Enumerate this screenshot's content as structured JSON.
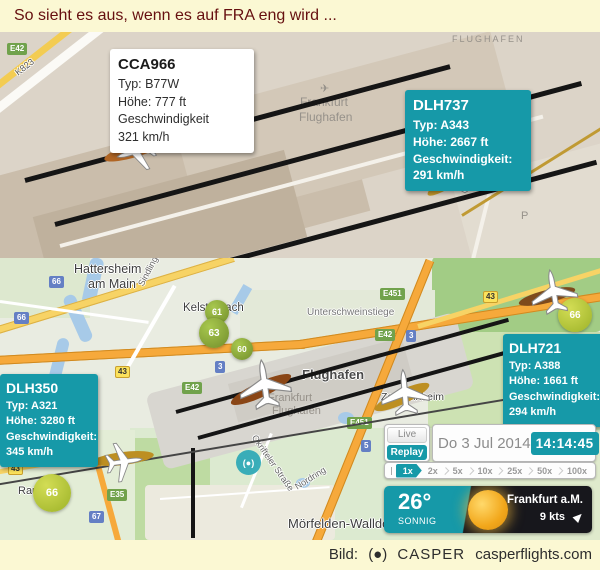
{
  "header": {
    "title": "So sieht es aus, wenn es auf FRA eng wird ..."
  },
  "footer": {
    "label": "Bild:",
    "logo": "(●)",
    "brand": "CASPER",
    "site": "casperflights.com"
  },
  "colors": {
    "accent_teal": "#1699a8",
    "runway": "#151515",
    "noise_green": "#8fb73e",
    "header_bg": "#fbf8d3"
  },
  "top_map": {
    "area_label": "FLUGHAFEN",
    "airport_symbol": "✈",
    "airport_name_line1": "Frankfurt",
    "airport_name_line2": "Flughafen",
    "road_k823": "K823",
    "badge_e42": "E42",
    "parking_label": "P"
  },
  "flights": [
    {
      "callsign": "CCA966",
      "typ": "Typ:  B77W",
      "hoehe": "Höhe: 777 ft",
      "speed_label": "Geschwindigkeit",
      "speed": "321 km/h"
    },
    {
      "callsign": "DLH737",
      "typ": "Typ: A343",
      "hoehe": "Höhe: 2667 ft",
      "speed_label": "Geschwindigkeit:",
      "speed": "291 km/h"
    },
    {
      "callsign": "DLH350",
      "typ": "Typ: A321",
      "hoehe": "Höhe: 3280 ft",
      "speed_label": "Geschwindigkeit:",
      "speed": "345 km/h"
    },
    {
      "callsign": "DLH721",
      "typ": "Typ: A388",
      "hoehe": "Höhe: 1661 ft",
      "speed_label": "Geschwindigkeit:",
      "speed": "294 km/h"
    }
  ],
  "bottom_map": {
    "towns": {
      "hattersheim_1": "Hattersheim",
      "hattersheim_2": "am Main",
      "kelsterbach": "Kelsterbach",
      "unterschweinstiege": "Unterschweinstiege",
      "zeppelinheim": "Zeppelinheim",
      "moerfelden": "Mörfelden-Walldorf",
      "raunheim": "Raunheim",
      "dreieich": "Dreieich",
      "flughafen_bold": "Flughafen",
      "airport_gray_1": "Frankfurt",
      "airport_gray_2": "Flughafen"
    },
    "streets": {
      "sindlinger": "Sindlinger Straße",
      "okrifteler": "Okrifteler Straße",
      "nordring": "Nordring"
    },
    "badges": [
      {
        "text": "66",
        "type": "blue"
      },
      {
        "text": "66",
        "type": "blue"
      },
      {
        "text": "43",
        "type": "yellow"
      },
      {
        "text": "E451",
        "type": "green"
      },
      {
        "text": "E42",
        "type": "green"
      },
      {
        "text": "3",
        "type": "blue"
      },
      {
        "text": "3",
        "type": "blue"
      },
      {
        "text": "E42",
        "type": "green"
      },
      {
        "text": "43",
        "type": "yellow"
      },
      {
        "text": "E451",
        "type": "green"
      },
      {
        "text": "5",
        "type": "blue"
      },
      {
        "text": "E35",
        "type": "green"
      },
      {
        "text": "67",
        "type": "blue"
      },
      {
        "text": "43",
        "type": "yellow"
      }
    ],
    "noise_markers": [
      "61",
      "63",
      "60",
      "66",
      "66"
    ],
    "watermark": "(●)"
  },
  "controls": {
    "live": "Live",
    "replay": "Replay",
    "date": "Do 3 Jul 2014",
    "time": "14:14:45",
    "speeds": [
      "1x",
      "2x",
      "5x",
      "10x",
      "25x",
      "50x",
      "100x"
    ],
    "selected_speed": "1x"
  },
  "weather": {
    "temp": "26°",
    "condition": "SONNIG",
    "location": "Frankfurt a.M.",
    "wind": "9 kts"
  }
}
